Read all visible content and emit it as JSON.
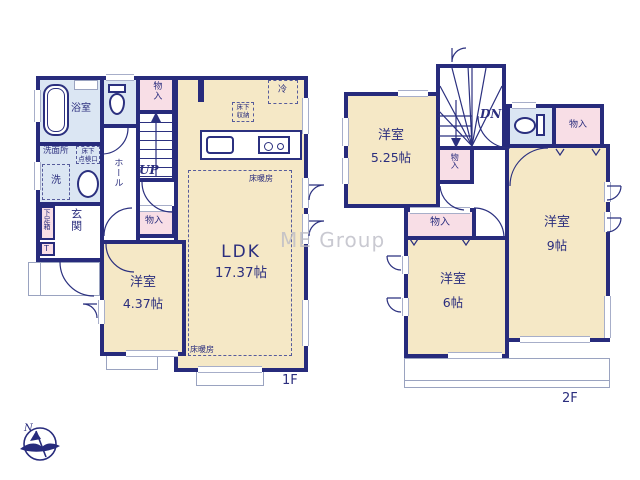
{
  "watermark": "ME Group",
  "compass": {
    "north": "N"
  },
  "colors": {
    "wall": "#272b7c",
    "room_cream": "#f5e8c6",
    "wet_blue": "#dbe6f3",
    "closet_pink": "#f8dee6"
  },
  "floor1": {
    "floor_label": "1F",
    "bath": "浴室",
    "washroom": "洗面所",
    "laundry": "洗",
    "inspection_l1": "床下",
    "inspection_l2": "点検口",
    "hall": "ホール",
    "genkan": "玄関",
    "shoebox": "下足箱",
    "shoebox_sub": "T",
    "closet_a": "物入",
    "closet_b": "物入",
    "stairs": "UP",
    "fridge": "冷",
    "storage_l1": "床下",
    "storage_l2": "収納",
    "ldk_name": "LDK",
    "ldk_size": "17.37帖",
    "heating_a": "床暖房",
    "heating_b": "床暖房",
    "bedroom_name": "洋室",
    "bedroom_size": "4.37帖"
  },
  "floor2": {
    "floor_label": "2F",
    "stairs": "DN",
    "closet_a": "物入",
    "closet_b": "物入",
    "closet_c": "物入",
    "bedroom_a_name": "洋室",
    "bedroom_a_size": "5.25帖",
    "bedroom_b_name": "洋室",
    "bedroom_b_size": "9帖",
    "bedroom_c_name": "洋室",
    "bedroom_c_size": "6帖"
  }
}
